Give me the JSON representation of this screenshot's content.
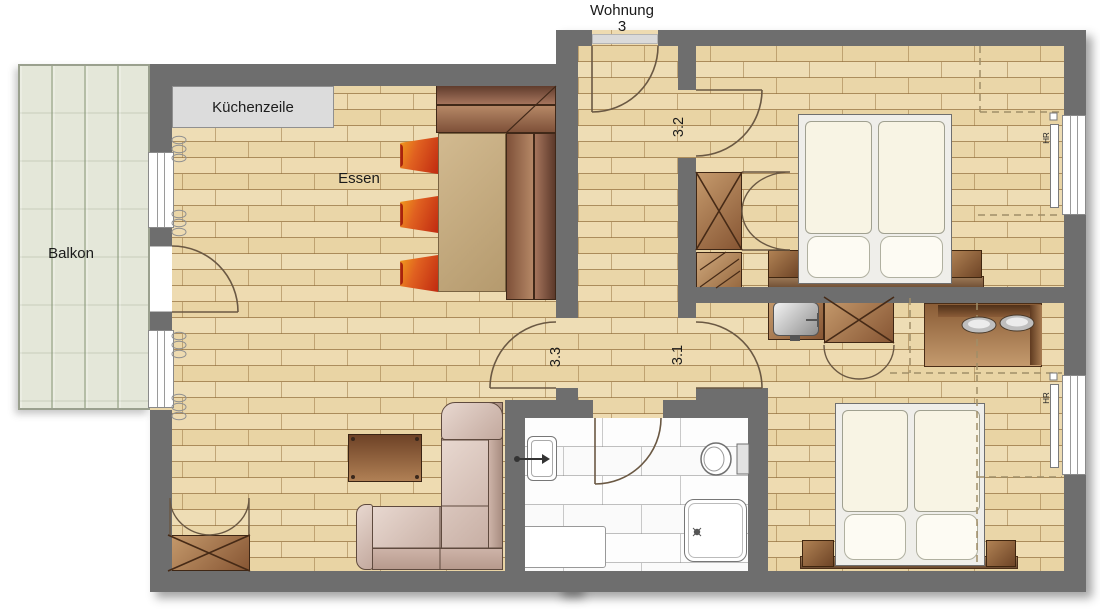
{
  "title": {
    "line1": "Wohnung",
    "line2": "3"
  },
  "labels": {
    "balcony": "Balkon",
    "kitchen_unit": "Küchenzeile",
    "dining": "Essen"
  },
  "door_labels": {
    "top_bedroom": "3.2",
    "living_room": "3.3",
    "bottom_bedroom": "3.1"
  },
  "radiators": {
    "label": "HR"
  },
  "colors": {
    "wall": "#6e6e6e",
    "parquet": "#ecd9ae",
    "parquet_line": "#b99a6b",
    "balcony_deck": "#e4e7d9",
    "tile": "#fdfdfd",
    "kitchen_unit": "#dcdcdc",
    "chair_accent": "#d9541b",
    "bench_brown": "#8a5a42",
    "sofa": "#d9c6bd",
    "door_stroke": "#6a5843"
  }
}
